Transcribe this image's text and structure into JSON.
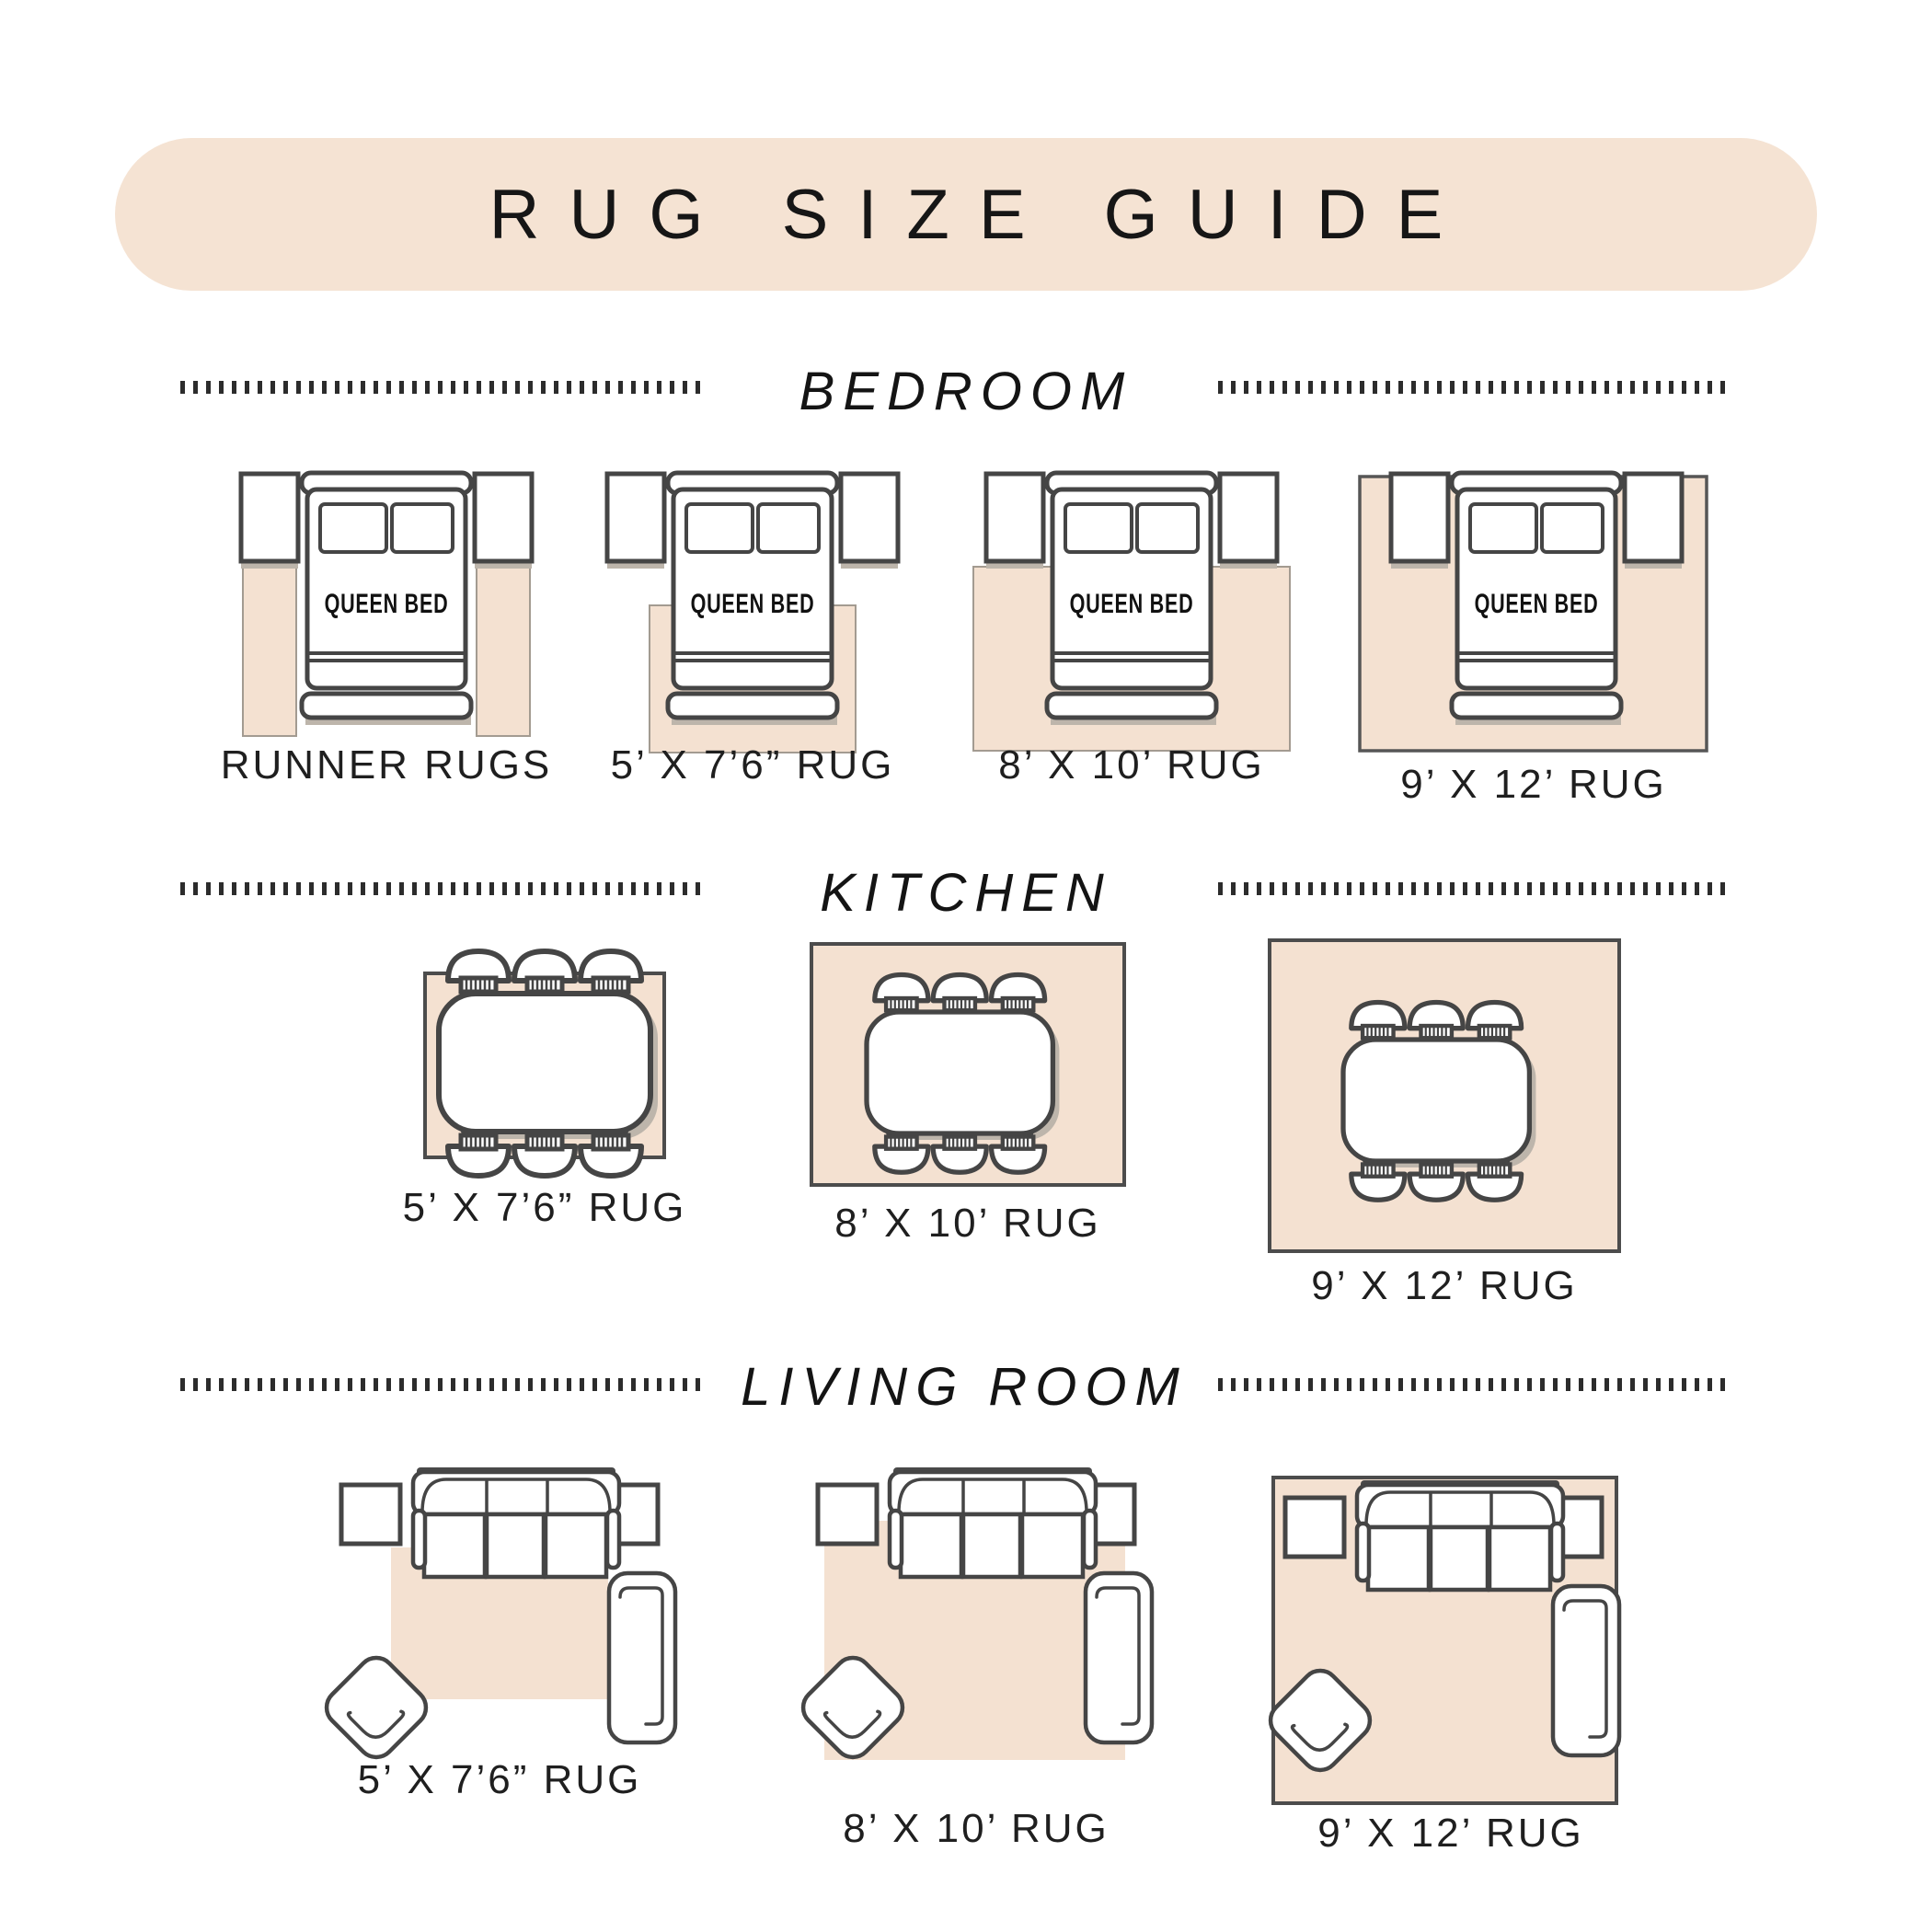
{
  "banner": {
    "title": "RUG SIZE GUIDE"
  },
  "sections": [
    {
      "title": "BEDROOM",
      "bed_label": "QUEEN BED",
      "figures": [
        {
          "caption": "RUNNER RUGS"
        },
        {
          "caption": "5’ X 7’6” RUG"
        },
        {
          "caption": "8’ X 10’ RUG"
        },
        {
          "caption": "9’ X 12’ RUG"
        }
      ]
    },
    {
      "title": "KITCHEN",
      "figures": [
        {
          "caption": "5’ X 7’6” RUG"
        },
        {
          "caption": "8’ X 10’ RUG"
        },
        {
          "caption": "9’ X 12’ RUG"
        }
      ]
    },
    {
      "title": "LIVING ROOM",
      "figures": [
        {
          "caption": "5’ X 7’6” RUG"
        },
        {
          "caption": "8’ X 10’ RUG"
        },
        {
          "caption": "9’ X 12’ RUG"
        }
      ]
    }
  ],
  "colors": {
    "banner_bg": "#f5e3d3",
    "rug_fill": "#f4e1d1",
    "outline": "#454545",
    "text": "#1f1f1f"
  }
}
